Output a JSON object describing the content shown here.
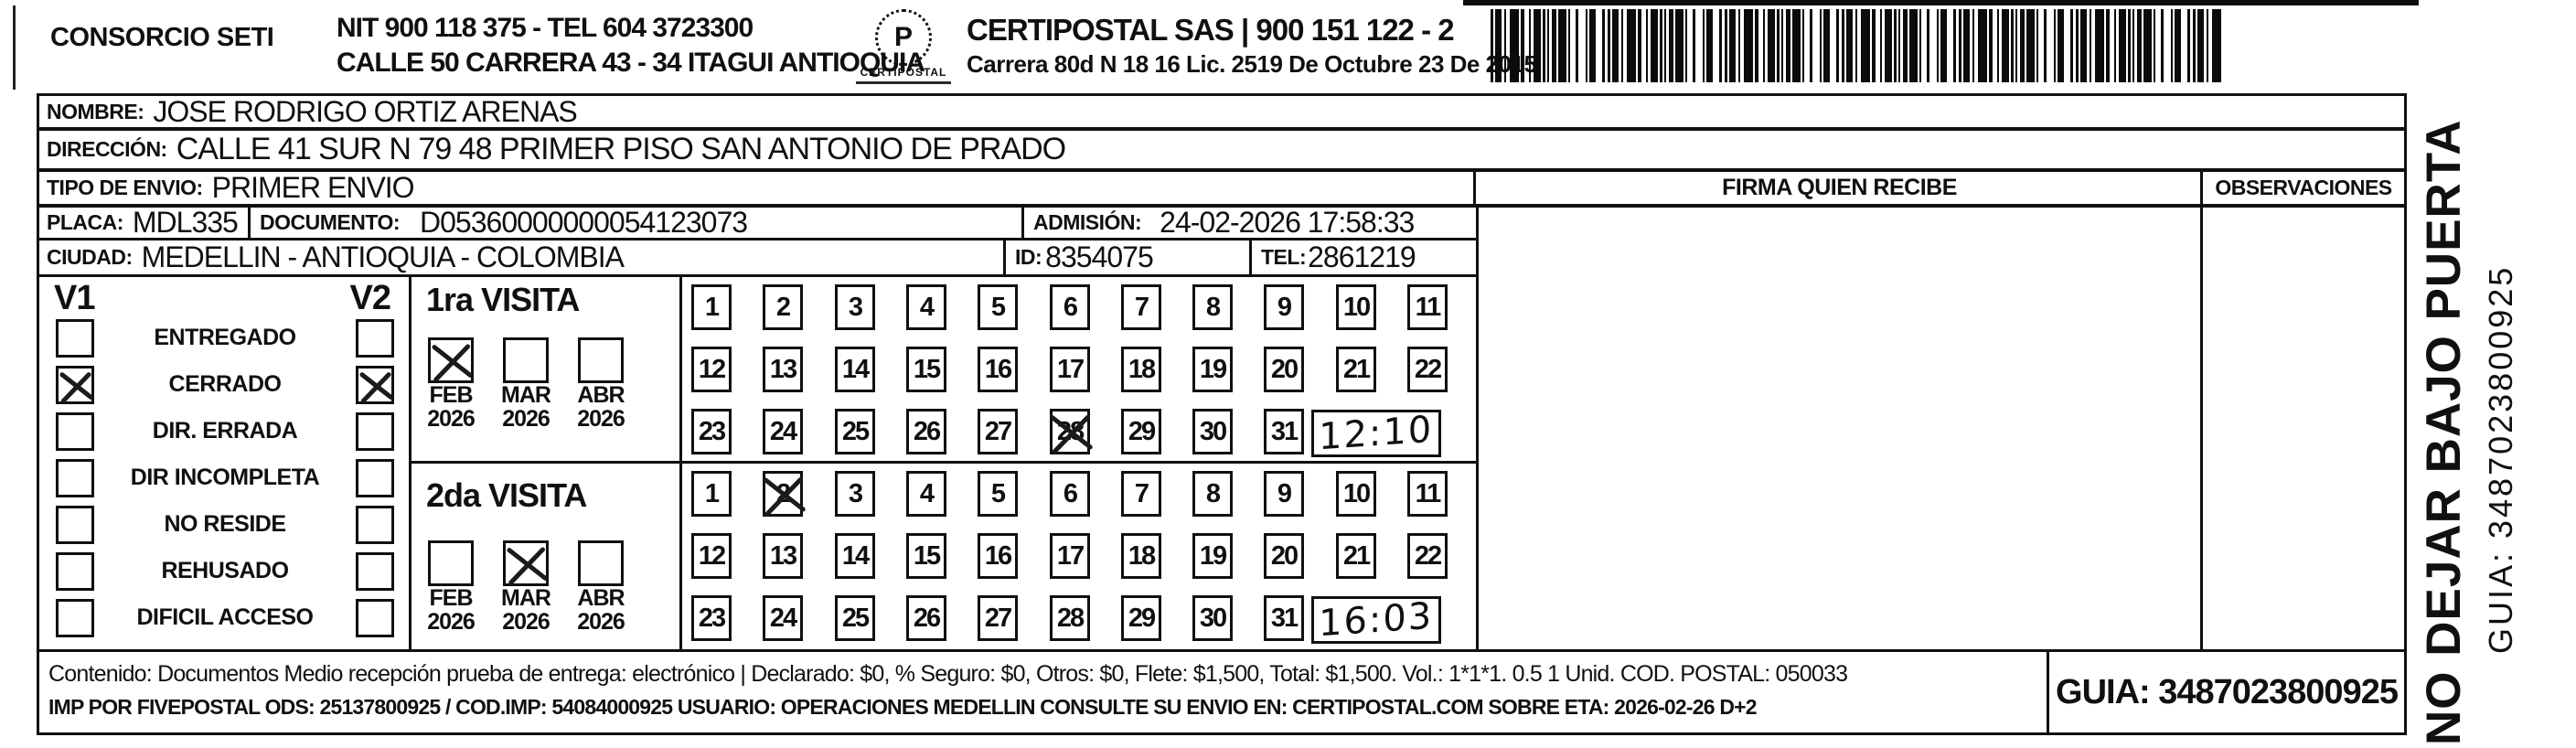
{
  "header": {
    "consorcio": "CONSORCIO SETI",
    "nit_line": "NIT 900 118 375 - TEL 604 3723300",
    "address_line": "CALLE 50 CARRERA 43 - 34 ITAGUI ANTIOQUIA",
    "logo_glyph": "P",
    "logo_word": "CERTIPOSTAL",
    "company_line": "CERTIPOSTAL SAS | 900 151 122 - 2",
    "company_address": "Carrera 80d N 18 16 Lic. 2519 De Octubre 23 De 2015"
  },
  "shipment": {
    "nombre_label": "NOMBRE:",
    "nombre": "JOSE RODRIGO ORTIZ ARENAS",
    "direccion_label": "DIRECCIÓN:",
    "direccion": "CALLE 41 SUR N 79 48 PRIMER PISO SAN ANTONIO DE PRADO",
    "tipo_label": "TIPO DE ENVIO:",
    "tipo": "PRIMER ENVIO",
    "placa_label": "PLACA:",
    "placa": "MDL335",
    "documento_label": "DOCUMENTO:",
    "documento": "D05360000000054123073",
    "admision_label": "ADMISIÓN:",
    "admision": "24-02-2026 17:58:33",
    "ciudad_label": "CIUDAD:",
    "ciudad": "MEDELLIN - ANTIOQUIA - COLOMBIA",
    "id_label": "ID:",
    "id": "8354075",
    "tel_label": "TEL:",
    "tel": "2861219"
  },
  "status_panel": {
    "v1_header": "V1",
    "v2_header": "V2",
    "options": [
      {
        "label": "ENTREGADO",
        "v1_checked": false,
        "v2_checked": false
      },
      {
        "label": "CERRADO",
        "v1_checked": true,
        "v2_checked": true
      },
      {
        "label": "DIR. ERRADA",
        "v1_checked": false,
        "v2_checked": false
      },
      {
        "label": "DIR INCOMPLETA",
        "v1_checked": false,
        "v2_checked": false
      },
      {
        "label": "NO RESIDE",
        "v1_checked": false,
        "v2_checked": false
      },
      {
        "label": "REHUSADO",
        "v1_checked": false,
        "v2_checked": false
      },
      {
        "label": "DIFICIL ACCESO",
        "v1_checked": false,
        "v2_checked": false
      }
    ]
  },
  "day_numbers": [
    1,
    2,
    3,
    4,
    5,
    6,
    7,
    8,
    9,
    10,
    11,
    12,
    13,
    14,
    15,
    16,
    17,
    18,
    19,
    20,
    21,
    22,
    23,
    24,
    25,
    26,
    27,
    28,
    29,
    30,
    31
  ],
  "visits": [
    {
      "title": "1ra VISITA",
      "months": [
        {
          "label": "FEB",
          "year": "2026",
          "checked": true
        },
        {
          "label": "MAR",
          "year": "2026",
          "checked": false
        },
        {
          "label": "ABR",
          "year": "2026",
          "checked": false
        }
      ],
      "crossed_day": 28,
      "handwritten_time": "12:10"
    },
    {
      "title": "2da VISITA",
      "months": [
        {
          "label": "FEB",
          "year": "2026",
          "checked": false
        },
        {
          "label": "MAR",
          "year": "2026",
          "checked": true
        },
        {
          "label": "ABR",
          "year": "2026",
          "checked": false
        }
      ],
      "crossed_day": 2,
      "handwritten_time": "16:03"
    }
  ],
  "signature_area": {
    "firma_header": "FIRMA QUIEN RECIBE",
    "observaciones_header": "OBSERVACIONES"
  },
  "side_note": {
    "warning": "NO DEJAR BAJO PUERTA",
    "guia": "GUIA: 3487023800925"
  },
  "footer": {
    "contenido": "Contenido: Documentos Medio recepción prueba de entrega: electrónico | Declarado: $0, % Seguro: $0, Otros: $0, Flete: $1,500, Total: $1,500. Vol.: 1*1*1. 0.5  1 Unid. COD. POSTAL: 050033",
    "imp": "IMP POR FIVEPOSTAL ODS: 25137800925 / COD.IMP: 54084000925 USUARIO: OPERACIONES MEDELLIN CONSULTE SU ENVIO EN: CERTIPOSTAL.COM SOBRE ETA: 2026-02-26 D+2",
    "guia_box": "GUIA: 3487023800925"
  }
}
